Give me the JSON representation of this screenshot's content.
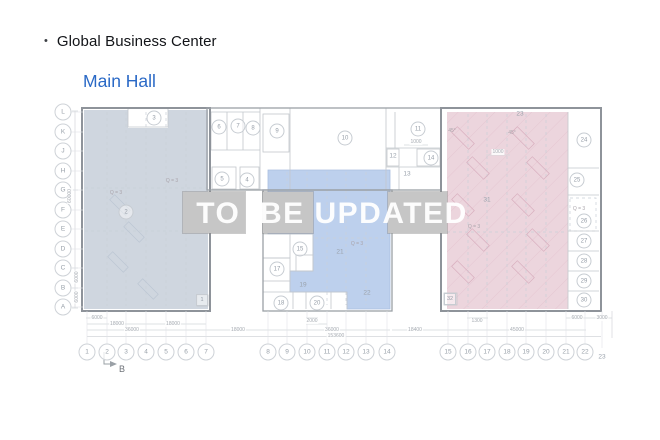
{
  "header": {
    "bullet": "•",
    "title": "Global Business Center",
    "subtitle": "Main Hall"
  },
  "watermark": {
    "text": "TO  BE UPDATED"
  },
  "colors": {
    "accent": "#2a69c6",
    "left_region": "#cfd6df",
    "middle_region": "#bdd0ed",
    "right_region": "#ecd5dd",
    "masked_box": "#c6c6c6",
    "watermark_text": "rgba(255,255,255,0.95)"
  },
  "plan": {
    "grid_row_x": 63,
    "grid_col_y": 352,
    "grid_rows": [
      {
        "label": "L",
        "y": 112
      },
      {
        "label": "K",
        "y": 132
      },
      {
        "label": "J",
        "y": 151
      },
      {
        "label": "H",
        "y": 171
      },
      {
        "label": "G",
        "y": 190
      },
      {
        "label": "F",
        "y": 210
      },
      {
        "label": "E",
        "y": 229
      },
      {
        "label": "D",
        "y": 249
      },
      {
        "label": "C",
        "y": 268
      },
      {
        "label": "B",
        "y": 288
      },
      {
        "label": "A",
        "y": 307
      }
    ],
    "grid_cols": [
      {
        "label": "1",
        "x": 87
      },
      {
        "label": "2",
        "x": 107
      },
      {
        "label": "3",
        "x": 126
      },
      {
        "label": "4",
        "x": 146
      },
      {
        "label": "5",
        "x": 166
      },
      {
        "label": "6",
        "x": 186
      },
      {
        "label": "7",
        "x": 206
      },
      {
        "label": "8",
        "x": 268
      },
      {
        "label": "9",
        "x": 287
      },
      {
        "label": "10",
        "x": 307
      },
      {
        "label": "11",
        "x": 327
      },
      {
        "label": "12",
        "x": 346
      },
      {
        "label": "13",
        "x": 366
      },
      {
        "label": "14",
        "x": 387
      },
      {
        "label": "15",
        "x": 448
      },
      {
        "label": "16",
        "x": 468
      },
      {
        "label": "17",
        "x": 487
      },
      {
        "label": "18",
        "x": 507
      },
      {
        "label": "19",
        "x": 526
      },
      {
        "label": "20",
        "x": 546
      },
      {
        "label": "21",
        "x": 566
      },
      {
        "label": "22",
        "x": 585
      },
      {
        "label": "23",
        "x": 602,
        "y": 357,
        "plain": true
      }
    ],
    "rooms": {
      "circled": [
        {
          "label": "3",
          "x": 154,
          "y": 118
        },
        {
          "label": "2",
          "x": 126,
          "y": 212
        },
        {
          "label": "6",
          "x": 219,
          "y": 127
        },
        {
          "label": "7",
          "x": 238,
          "y": 126
        },
        {
          "label": "8",
          "x": 253,
          "y": 128
        },
        {
          "label": "9",
          "x": 277,
          "y": 131
        },
        {
          "label": "5",
          "x": 222,
          "y": 179
        },
        {
          "label": "4",
          "x": 247,
          "y": 180
        },
        {
          "label": "10",
          "x": 345,
          "y": 138
        },
        {
          "label": "11",
          "x": 418,
          "y": 129
        },
        {
          "label": "14",
          "x": 431,
          "y": 158
        },
        {
          "label": "15",
          "x": 300,
          "y": 249
        },
        {
          "label": "17",
          "x": 277,
          "y": 269
        },
        {
          "label": "18",
          "x": 281,
          "y": 303
        },
        {
          "label": "20",
          "x": 317,
          "y": 303
        },
        {
          "label": "24",
          "x": 584,
          "y": 140
        },
        {
          "label": "25",
          "x": 577,
          "y": 180
        },
        {
          "label": "26",
          "x": 584,
          "y": 221
        },
        {
          "label": "27",
          "x": 584,
          "y": 241
        },
        {
          "label": "28",
          "x": 584,
          "y": 261
        },
        {
          "label": "29",
          "x": 584,
          "y": 281
        },
        {
          "label": "30",
          "x": 584,
          "y": 300
        }
      ],
      "plain": [
        {
          "label": "12",
          "x": 393,
          "y": 156
        },
        {
          "label": "13",
          "x": 407,
          "y": 174
        },
        {
          "label": "19",
          "x": 303,
          "y": 285
        },
        {
          "label": "21",
          "x": 340,
          "y": 252
        },
        {
          "label": "22",
          "x": 367,
          "y": 293
        },
        {
          "label": "23",
          "x": 520,
          "y": 114
        },
        {
          "label": "31",
          "x": 487,
          "y": 200
        }
      ],
      "boxed": [
        {
          "label": "1",
          "x": 202,
          "y": 300
        },
        {
          "label": "32",
          "x": 450,
          "y": 299
        }
      ]
    },
    "dimensions": [
      {
        "text": "6000",
        "x": 97,
        "y": 318
      },
      {
        "text": "2000",
        "x": 312,
        "y": 321
      },
      {
        "text": "1300",
        "x": 477,
        "y": 321
      },
      {
        "text": "6000",
        "x": 577,
        "y": 318
      },
      {
        "text": "3000",
        "x": 602,
        "y": 318
      },
      {
        "text": "18000",
        "x": 117,
        "y": 324
      },
      {
        "text": "18000",
        "x": 173,
        "y": 324
      },
      {
        "text": "36000",
        "x": 132,
        "y": 330
      },
      {
        "text": "18000",
        "x": 238,
        "y": 330
      },
      {
        "text": "36000",
        "x": 332,
        "y": 330
      },
      {
        "text": "18400",
        "x": 415,
        "y": 330
      },
      {
        "text": "45000",
        "x": 517,
        "y": 330
      },
      {
        "text": "153600",
        "x": 336,
        "y": 336
      },
      {
        "text": "1000",
        "x": 416,
        "y": 142
      },
      {
        "text": "1000",
        "x": 498,
        "y": 152
      },
      {
        "text": "60000",
        "x": 70,
        "y": 196,
        "rot": true
      },
      {
        "text": "6000",
        "x": 77,
        "y": 277,
        "rot": true
      },
      {
        "text": "6000",
        "x": 77,
        "y": 297,
        "rot": true
      }
    ],
    "notes": [
      {
        "text": "Q = 3",
        "x": 172,
        "y": 181
      },
      {
        "text": "Q = 3",
        "x": 116,
        "y": 193
      },
      {
        "text": "Q = 3",
        "x": 357,
        "y": 244
      },
      {
        "text": "Q = 3",
        "x": 474,
        "y": 227
      },
      {
        "text": "Q = 3",
        "x": 579,
        "y": 209
      },
      {
        "text": "45°",
        "x": 452,
        "y": 131
      },
      {
        "text": "45°",
        "x": 512,
        "y": 133
      }
    ],
    "section_marker": {
      "label": "B",
      "x": 122,
      "y": 369
    }
  }
}
